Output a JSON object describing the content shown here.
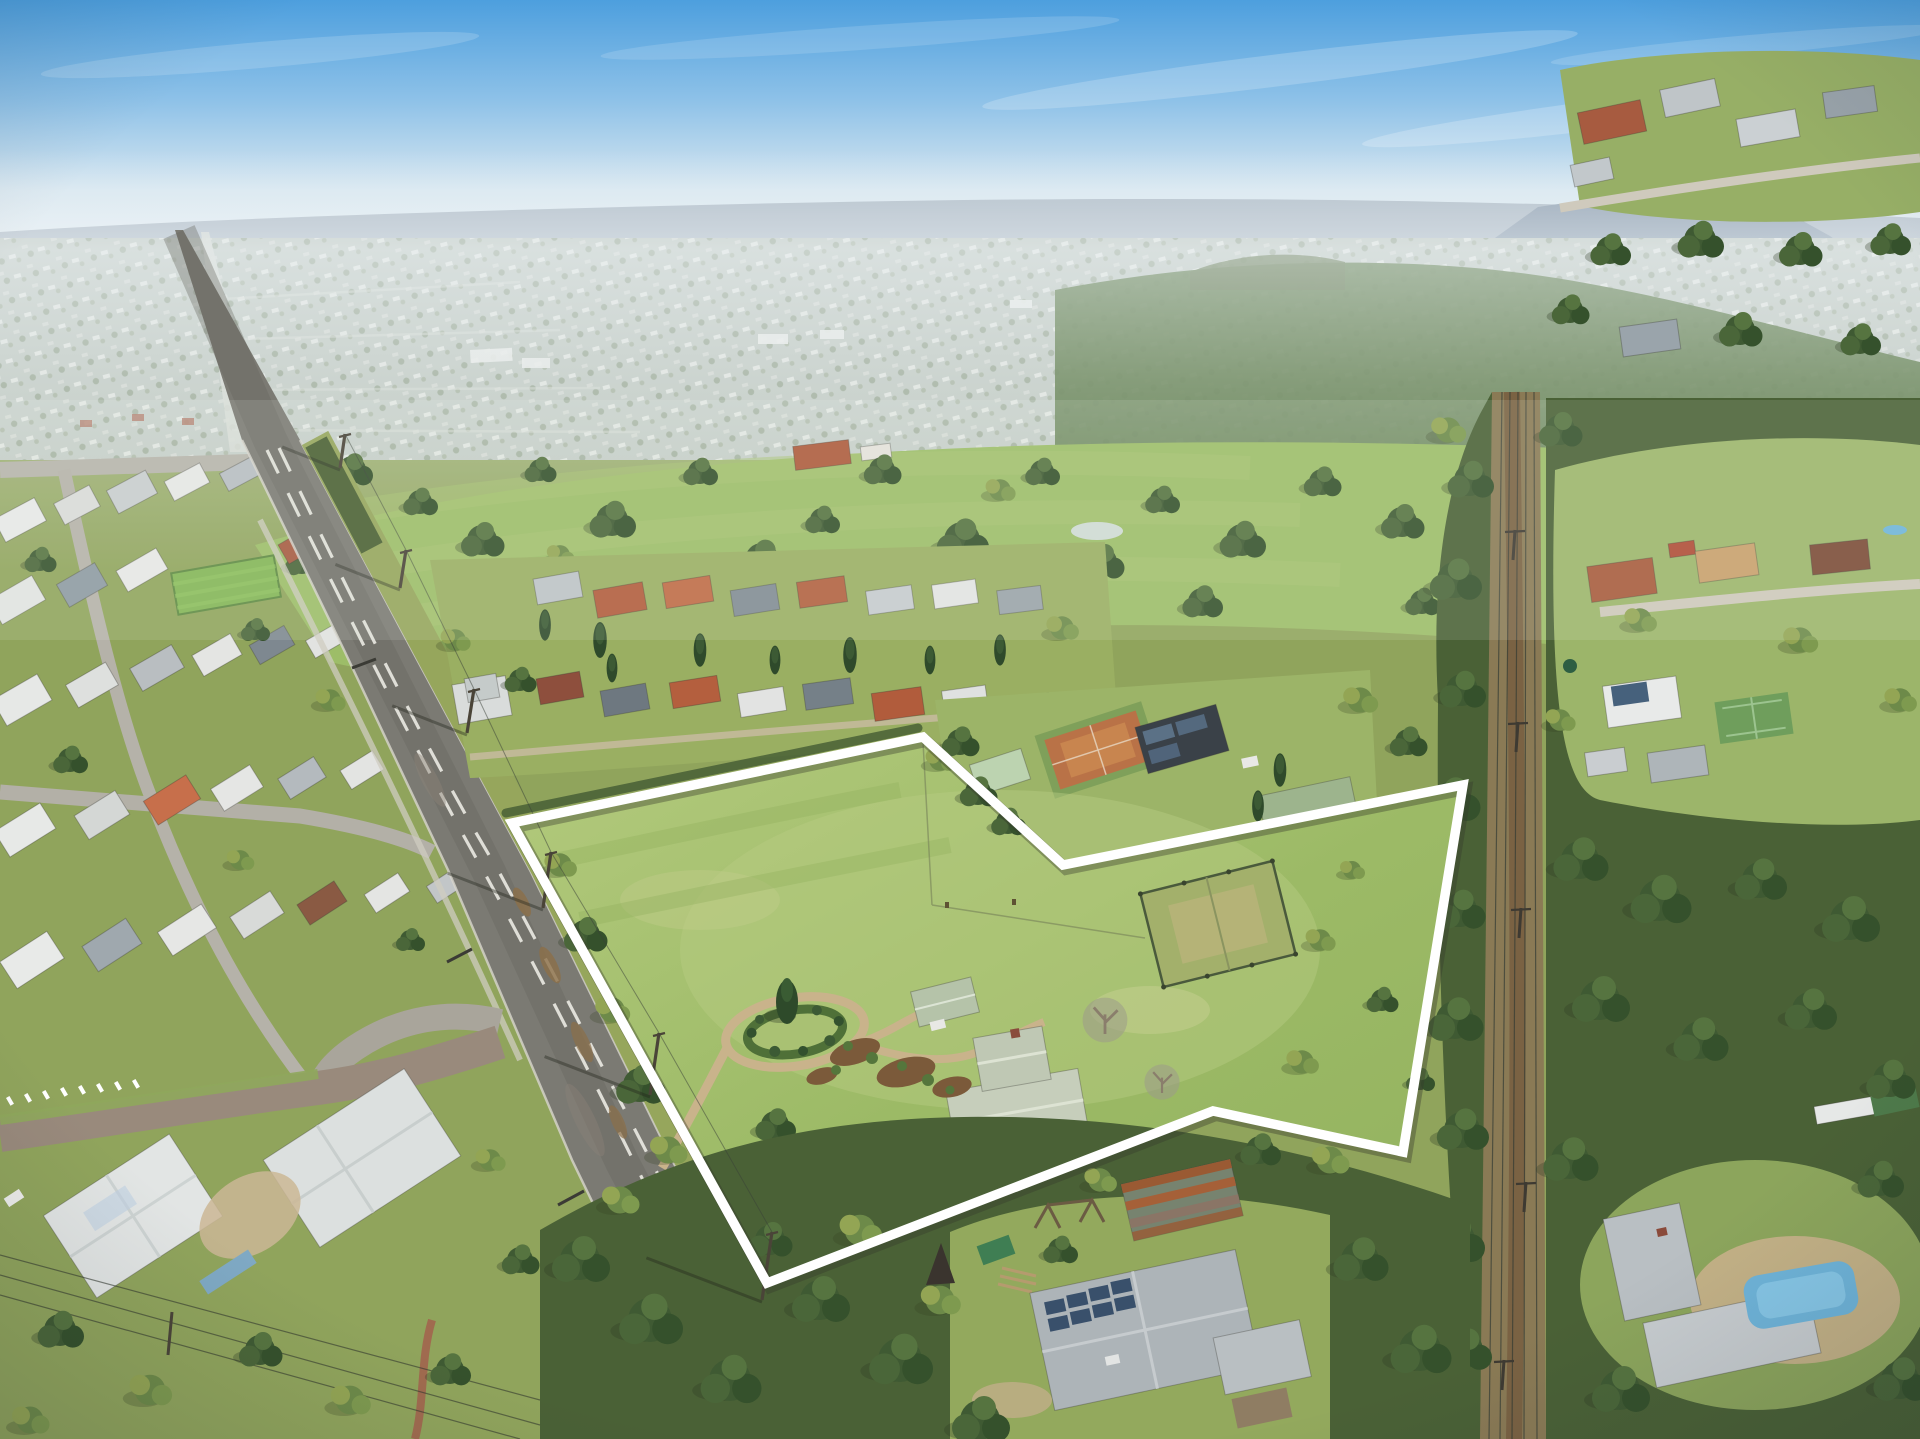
{
  "meta": {
    "type": "aerial-drone-photograph",
    "description": "Oblique aerial real-estate photograph of a large semi-rural acreage property outlined with a white boundary line, beside a suburban street grid, a golf course, a tree-lined power-line laneway and distant hazy township and flat-topped mountain.",
    "visible_text": "none"
  },
  "palette": {
    "sky_top": "#4D9FDE",
    "sky_mid": "#8FC2E8",
    "sky_low": "#D8E7F0",
    "sky_horizon": "#EDF1F2",
    "haze": "#EEF3F6",
    "ridge_far": "#A2AFBC",
    "ridge_mid": "#97A6A8",
    "mountain": "#8C9CAD",
    "distant_urban": "#BFC8C0",
    "forest_dark": "#42592F",
    "forest_deep": "#4A6136",
    "forest_mid": "#567440",
    "canopy_light": "#7E9A4F",
    "grass_base": "#90A45C",
    "grass_fairway": "#9DBD68",
    "grass_lawn": "#9AAF62",
    "paddock_light": "#B3CA7D",
    "paddock_mid": "#9CBA66",
    "paddock_dark": "#93B25F",
    "dirt_tan": "#C9B38B",
    "dirt_red": "#8C6F49",
    "road_asphalt": "#7B7A73",
    "road_dark": "#585751",
    "concrete": "#D8D6CD",
    "brick_street": "#998A7C",
    "roof_white": "#E7E9E8",
    "roof_grey": "#B9BFC3",
    "roof_slate": "#79838B",
    "roof_terracotta": "#AE5B3C",
    "roof_red": "#C06A45",
    "roof_brown": "#7C4A36",
    "roof_sage": "#C6CEBB",
    "roof_black": "#3A4148",
    "pool_blue": "#6FB4D9",
    "corridor_tan": "#8A7A55",
    "corridor_track": "#7A6243",
    "boundary_white": "#FFFFFF"
  },
  "boundary": {
    "stroke_color": "#FFFFFF",
    "stroke_width": 9.5,
    "shadow_color": "rgba(55,58,45,0.38)",
    "shadow_width": 12,
    "points": [
      [
        512,
        823
      ],
      [
        923,
        737
      ],
      [
        1063,
        865
      ],
      [
        1463,
        785
      ],
      [
        1403,
        1152
      ],
      [
        1213,
        1111
      ],
      [
        767,
        1283
      ]
    ]
  },
  "road_poles": [
    {
      "x": 340,
      "y": 468,
      "h": 34,
      "lean": 5
    },
    {
      "x": 400,
      "y": 588,
      "h": 38,
      "lean": 6
    },
    {
      "x": 467,
      "y": 733,
      "h": 44,
      "lean": 7
    },
    {
      "x": 543,
      "y": 908,
      "h": 56,
      "lean": 8
    },
    {
      "x": 650,
      "y": 1095,
      "h": 62,
      "lean": 9
    },
    {
      "x": 762,
      "y": 1300,
      "h": 68,
      "lean": 10
    }
  ],
  "corridor_poles": [
    {
      "x": 1513,
      "y": 560
    },
    {
      "x": 1516,
      "y": 752
    },
    {
      "x": 1519,
      "y": 938
    },
    {
      "x": 1524,
      "y": 1212
    },
    {
      "x": 1502,
      "y": 1390
    }
  ],
  "corridor_wires": [
    {
      "x1": 1502,
      "y1": 392,
      "x2": 1489,
      "y2": 1439
    },
    {
      "x1": 1510,
      "y1": 392,
      "x2": 1500,
      "y2": 1439
    },
    {
      "x1": 1518,
      "y1": 392,
      "x2": 1512,
      "y2": 1439
    },
    {
      "x1": 1526,
      "y1": 392,
      "x2": 1524,
      "y2": 1439
    },
    {
      "x1": 1534,
      "y1": 392,
      "x2": 1537,
      "y2": 1439
    }
  ],
  "landmarks": [
    {
      "name": "property-boundary-area",
      "x": 480,
      "y": 705,
      "w": 1000,
      "h": 600
    },
    {
      "name": "homestead",
      "x": 945,
      "y": 1055,
      "w": 165,
      "h": 105
    },
    {
      "name": "garage-shed",
      "x": 905,
      "y": 975,
      "w": 85,
      "h": 58
    },
    {
      "name": "circular-garden",
      "x": 715,
      "y": 985,
      "w": 160,
      "h": 95
    },
    {
      "name": "grass-tennis-court",
      "x": 1140,
      "y": 862,
      "w": 155,
      "h": 128
    },
    {
      "name": "clay-tennis-court",
      "x": 1032,
      "y": 712,
      "w": 125,
      "h": 78
    },
    {
      "name": "solar-barn",
      "x": 1135,
      "y": 705,
      "w": 100,
      "h": 70
    },
    {
      "name": "golf-course",
      "x": 290,
      "y": 418,
      "w": 1270,
      "h": 245
    },
    {
      "name": "main-road",
      "x": 175,
      "y": 230,
      "w": 660,
      "h": 1209
    },
    {
      "name": "power-line-laneway",
      "x": 1472,
      "y": 388,
      "w": 84,
      "h": 1051
    },
    {
      "name": "pool-house",
      "x": 1595,
      "y": 1150,
      "w": 310,
      "h": 245
    },
    {
      "name": "solar-roof-house",
      "x": 1000,
      "y": 1250,
      "w": 315,
      "h": 189
    },
    {
      "name": "left-suburb",
      "x": 0,
      "y": 425,
      "w": 480,
      "h": 1014
    },
    {
      "name": "brick-side-street",
      "x": 0,
      "y": 1030,
      "w": 515,
      "h": 145
    },
    {
      "name": "distant-township",
      "x": 0,
      "y": 228,
      "w": 1920,
      "h": 225
    },
    {
      "name": "table-top-mountain",
      "x": 1495,
      "y": 183,
      "w": 270,
      "h": 62
    },
    {
      "name": "sky",
      "x": 0,
      "y": 0,
      "w": 1920,
      "h": 230
    }
  ]
}
